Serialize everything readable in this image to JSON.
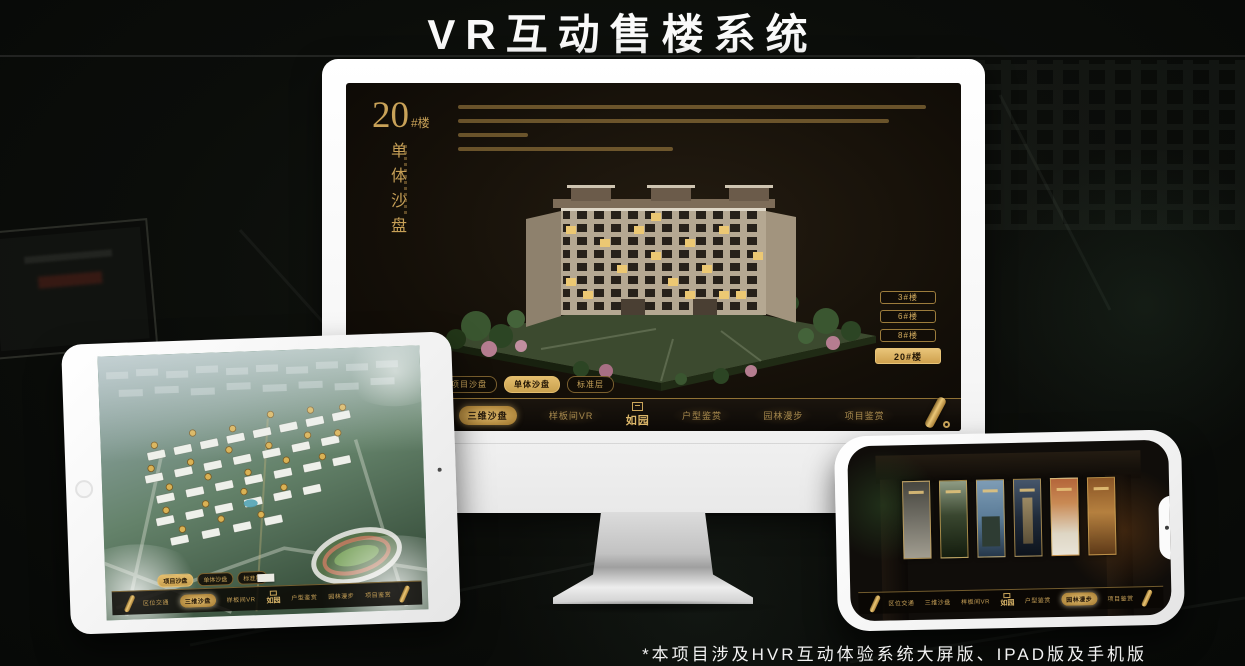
{
  "page": {
    "title": "VR互动售楼系统",
    "footnote": "*本项目涉及HVR互动体验系统大屏版、IPAD版及手机版"
  },
  "colors": {
    "gold": "#c9a258",
    "gold_active": "#e3bd6d",
    "monitor_screen_bg": "#140f08",
    "device_frame": "#ffffff"
  },
  "tabs": [
    "项目沙盘",
    "单体沙盘",
    "标准层"
  ],
  "nav": {
    "items": [
      "区位交通",
      "三维沙盘",
      "样板间VR",
      "户型鉴赏",
      "园林漫步",
      "项目鉴赏"
    ],
    "logo": "如园"
  },
  "monitor": {
    "building_no": "20",
    "building_no_suffix": "#楼",
    "vertical_label": "单体沙盘",
    "floor_buttons": [
      "3#楼",
      "6#楼",
      "8#楼",
      "20#楼"
    ],
    "active_floor": "20#楼",
    "active_tab": "单体沙盘",
    "active_nav": "三维沙盘"
  },
  "tablet": {
    "active_tab": "项目沙盘",
    "active_nav": "三维沙盘"
  },
  "phone": {
    "active_nav": "园林漫步"
  }
}
